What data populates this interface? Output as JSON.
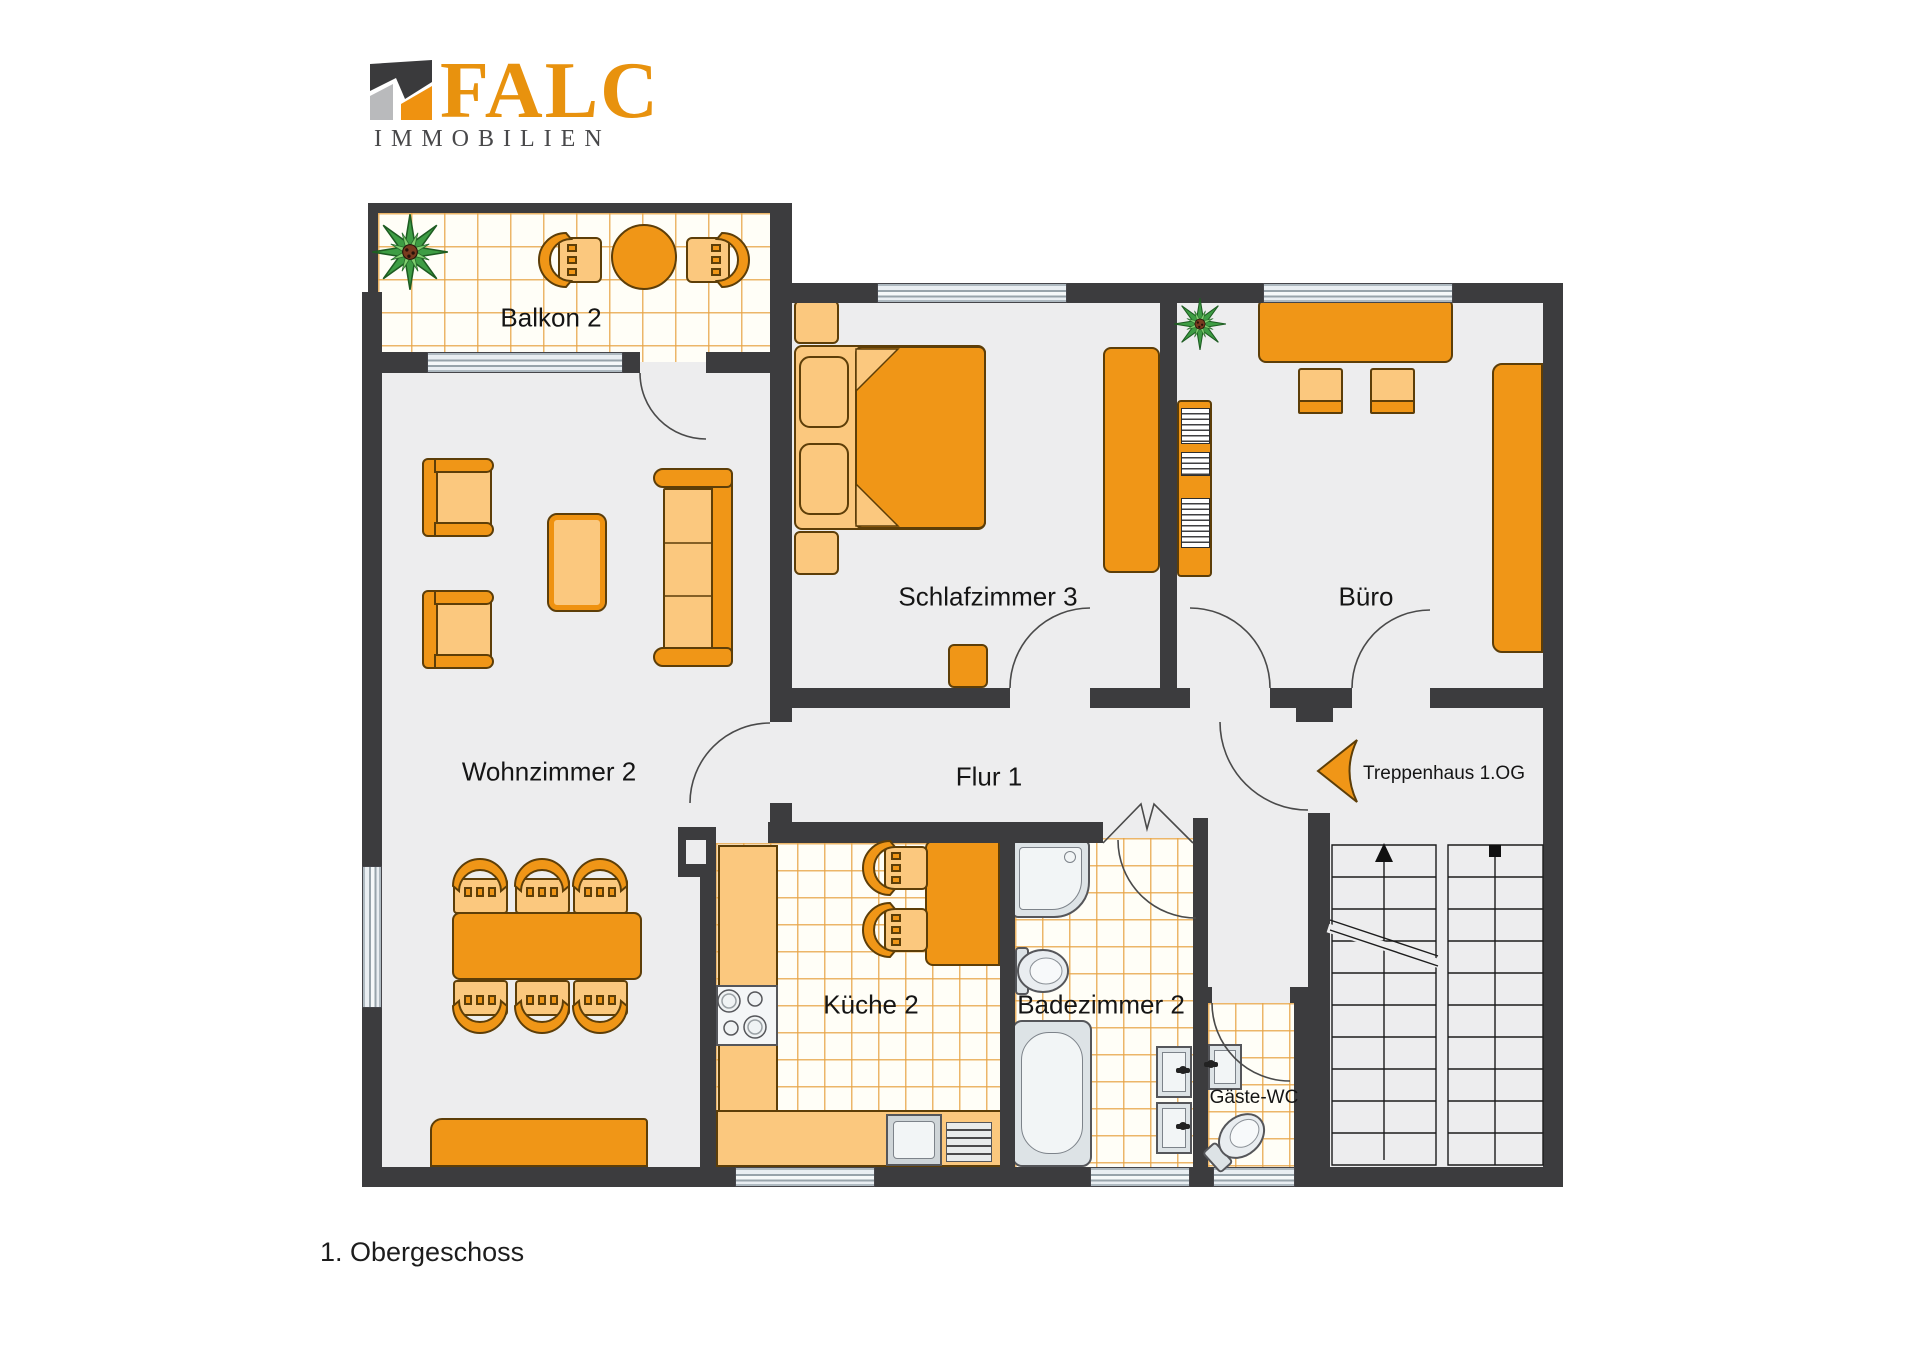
{
  "logo": {
    "brand": "FALC",
    "subtitle": "IMMOBILIEN",
    "icon": "falc-roof-icon",
    "brand_color": "#E8920E",
    "subtitle_color": "#48484A"
  },
  "floor_plan": {
    "title": "1. Obergeschoss",
    "rooms": [
      {
        "id": "balkon",
        "label": "Balkon 2"
      },
      {
        "id": "wohnzimmer",
        "label": "Wohnzimmer 2"
      },
      {
        "id": "schlafzimmer",
        "label": "Schlafzimmer 3"
      },
      {
        "id": "buero",
        "label": "Büro"
      },
      {
        "id": "flur",
        "label": "Flur 1"
      },
      {
        "id": "kueche",
        "label": "Küche 2"
      },
      {
        "id": "badezimmer",
        "label": "Badezimmer 2"
      },
      {
        "id": "gaeste_wc",
        "label": "Gäste-WC"
      },
      {
        "id": "treppenhaus",
        "label": "Treppenhaus 1.OG"
      }
    ],
    "colors": {
      "wall": "#3C3C3E",
      "floor": "#EDEDEE",
      "furniture": "#F09617",
      "furniture_light": "#FBC87E",
      "tile_line": "#E7A446",
      "window_glass": "#E9EEF2"
    },
    "icons": [
      "plant-icon",
      "entry-arrow-icon",
      "stairs-up-arrow-icon"
    ]
  }
}
